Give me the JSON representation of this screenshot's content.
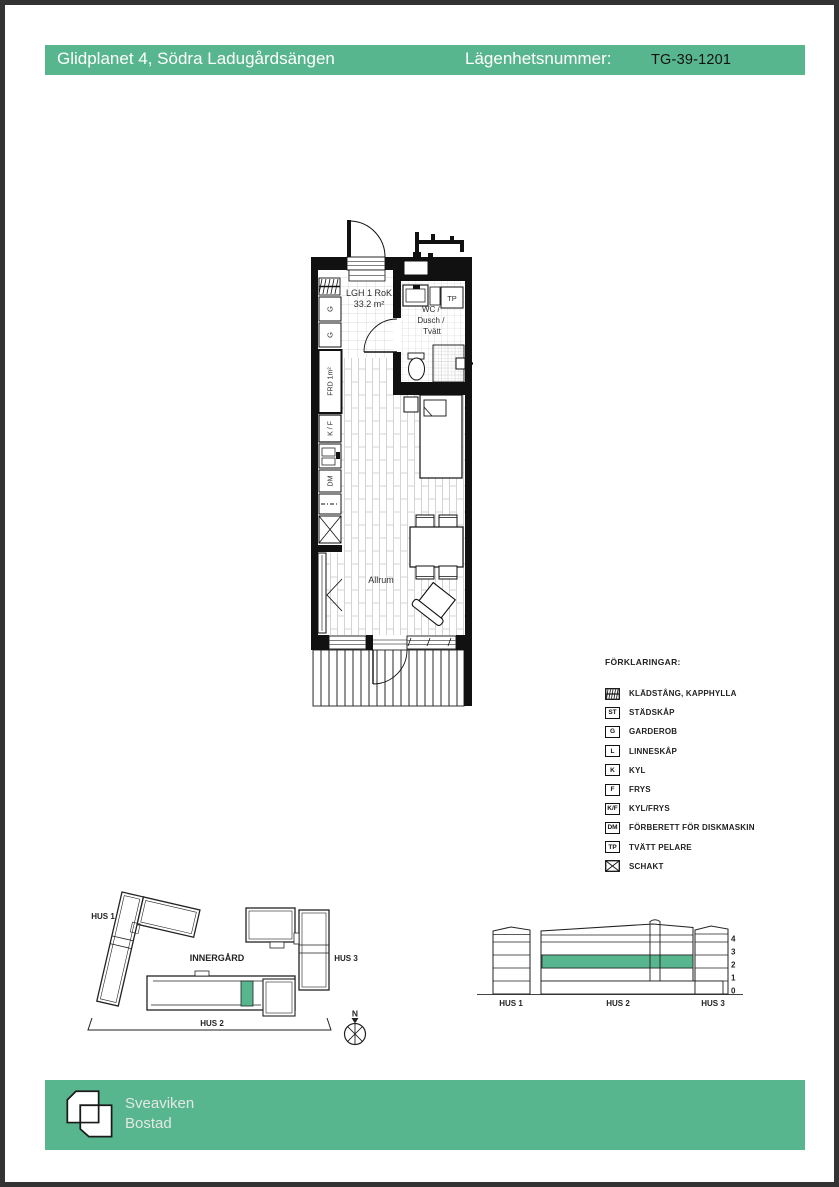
{
  "colors": {
    "accent_green": "#58b68e",
    "border_dark": "#333333",
    "wall": "#111111"
  },
  "header": {
    "title": "Glidplanet 4, Södra Ladugårdsängen",
    "apartment_label": "Lägenhetsnummer:",
    "apartment_value": "TG-39-1201"
  },
  "floorplan": {
    "unit_type": "LGH 1 RoK",
    "unit_area": "33.2 m²",
    "wc_line1": "WC /",
    "wc_line2": "Dusch /",
    "wc_line3": "Tvätt",
    "tp": "TP",
    "allrum": "Allrum",
    "frd": "FRD 1m²",
    "g_upper": "G",
    "g_lower": "G",
    "kf": "K / F",
    "dm": "DM"
  },
  "legend": {
    "title": "FÖRKLARINGAR:",
    "items": [
      {
        "symbol": "",
        "label": "KLÄDSTÅNG, KAPPHYLLA"
      },
      {
        "symbol": "ST",
        "label": "STÄDSKÅP"
      },
      {
        "symbol": "G",
        "label": "GARDEROB"
      },
      {
        "symbol": "L",
        "label": "LINNESKÅP"
      },
      {
        "symbol": "K",
        "label": "KYL"
      },
      {
        "symbol": "F",
        "label": "FRYS"
      },
      {
        "symbol": "K/F",
        "label": "KYL/FRYS"
      },
      {
        "symbol": "DM",
        "label": "FÖRBERETT FÖR DISKMASKIN"
      },
      {
        "symbol": "TP",
        "label": "TVÄTT PELARE"
      },
      {
        "symbol": "",
        "label": "SCHAKT"
      }
    ]
  },
  "siteplan": {
    "hus1": "HUS 1",
    "hus2": "HUS 2",
    "hus3": "HUS 3",
    "innergard": "INNERGÅRD",
    "north": "N"
  },
  "elevation": {
    "hus1": "HUS 1",
    "hus2": "HUS 2",
    "hus3": "HUS 3",
    "levels": [
      "4",
      "3",
      "2",
      "1",
      "0"
    ]
  },
  "footer": {
    "brand_line1": "Sveaviken",
    "brand_line2": "Bostad"
  }
}
